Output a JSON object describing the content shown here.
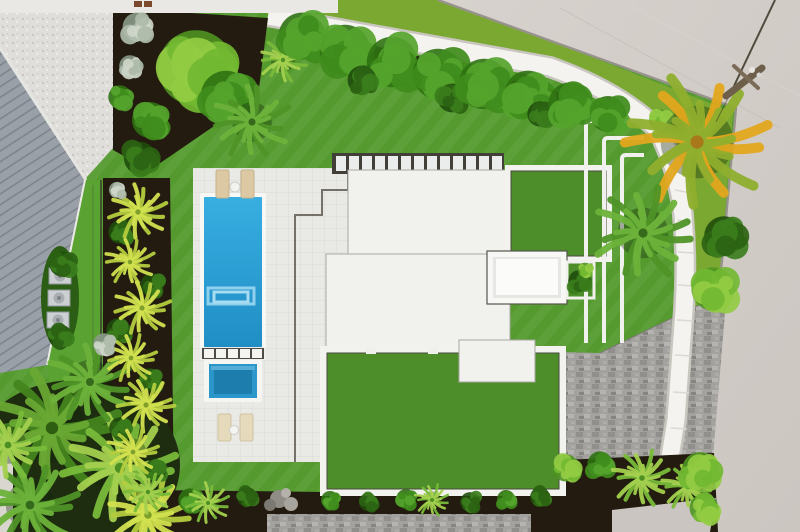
{
  "scene": {
    "description": "Aerial drone photograph of a modern flat-roof home with rectangular swimming pool, spa, white sun deck, artificial turf lawn and roof sections, curved white walkway, tropical landscaping and street at top right",
    "palette": {
      "lawn": "#549a2e",
      "verge": "#7aa831",
      "road": "#d1ccc7",
      "roadEdge": "#97938c",
      "walk": "#f4f3ef",
      "walkShadow": "#c9c5bf",
      "mulch": "#241b10",
      "metal": "#99a0a8",
      "roof": "#f1f1ee",
      "turf": "#4d8e2a",
      "deck": "#e9e9e5",
      "pool": "#2ba6da",
      "poolDeep": "#1f8ec4",
      "spa": "#2b96ca",
      "spaDeep": "#1d7eae",
      "pavers": "#a4a29e",
      "neighborPav": "#e0deda",
      "sidewalk": "#e9e8e4",
      "fence": "#39362e",
      "lounger": "#dcc9a4"
    },
    "house": {
      "paver_row": {
        "x": 336,
        "y": 156,
        "w": 10,
        "h": 15,
        "step": 13,
        "count": 13
      }
    },
    "pool": {
      "divider_squares": {
        "x": 204,
        "y": 349,
        "w": 10,
        "h": 9,
        "step": 12,
        "count": 5
      }
    },
    "vegetation": [
      {
        "type": "palm",
        "kind": "mixG",
        "x": 52,
        "y": 428,
        "r": 62
      },
      {
        "type": "palm",
        "kind": "bright",
        "x": 120,
        "y": 468,
        "r": 52
      },
      {
        "type": "palm",
        "kind": "green",
        "x": 30,
        "y": 505,
        "r": 44
      },
      {
        "type": "palm",
        "kind": "yellow",
        "x": 148,
        "y": 515,
        "r": 38
      },
      {
        "type": "palm",
        "kind": "green",
        "x": 90,
        "y": 382,
        "r": 40
      },
      {
        "type": "palm",
        "kind": "bright",
        "x": 8,
        "y": 445,
        "r": 34
      },
      {
        "type": "bush",
        "kind": "bushDark",
        "x": 120,
        "y": 232,
        "r": 13
      },
      {
        "type": "bush",
        "kind": "bushDark",
        "x": 152,
        "y": 285,
        "r": 13
      },
      {
        "type": "bush",
        "kind": "bushDark",
        "x": 118,
        "y": 330,
        "r": 13
      },
      {
        "type": "bush",
        "kind": "bushDark",
        "x": 150,
        "y": 380,
        "r": 13
      },
      {
        "type": "bush",
        "kind": "bushDark",
        "x": 120,
        "y": 428,
        "r": 12
      },
      {
        "type": "bush",
        "kind": "bushDark",
        "x": 155,
        "y": 470,
        "r": 12
      },
      {
        "type": "palm",
        "kind": "yellow",
        "x": 138,
        "y": 212,
        "r": 27
      },
      {
        "type": "palm",
        "kind": "yellow",
        "x": 130,
        "y": 262,
        "r": 23
      },
      {
        "type": "palm",
        "kind": "yellow",
        "x": 142,
        "y": 308,
        "r": 26
      },
      {
        "type": "palm",
        "kind": "yellow",
        "x": 131,
        "y": 358,
        "r": 24
      },
      {
        "type": "palm",
        "kind": "yellow",
        "x": 146,
        "y": 405,
        "r": 26
      },
      {
        "type": "palm",
        "kind": "yellow",
        "x": 133,
        "y": 452,
        "r": 24
      },
      {
        "type": "palm",
        "kind": "bright",
        "x": 148,
        "y": 492,
        "r": 22
      },
      {
        "type": "bush",
        "kind": "silver",
        "x": 137,
        "y": 27,
        "r": 16
      },
      {
        "type": "bush",
        "kind": "silver",
        "x": 130,
        "y": 66,
        "r": 12
      },
      {
        "type": "bush",
        "kind": "silver",
        "x": 104,
        "y": 344,
        "r": 12
      },
      {
        "type": "bush",
        "kind": "silver",
        "x": 117,
        "y": 190,
        "r": 9
      },
      {
        "type": "bush",
        "kind": "bush",
        "x": 150,
        "y": 120,
        "r": 20
      },
      {
        "type": "bush",
        "kind": "bushDark",
        "x": 140,
        "y": 158,
        "r": 18
      },
      {
        "type": "bush",
        "kind": "bush",
        "x": 120,
        "y": 97,
        "r": 13
      },
      {
        "type": "bush",
        "kind": "bushBright",
        "x": 196,
        "y": 68,
        "r": 42
      },
      {
        "type": "bush",
        "kind": "bush",
        "x": 226,
        "y": 96,
        "r": 28
      },
      {
        "type": "palm",
        "kind": "green",
        "x": 252,
        "y": 122,
        "r": 36
      },
      {
        "type": "palm",
        "kind": "bright",
        "x": 283,
        "y": 60,
        "r": 22
      },
      {
        "type": "bush",
        "kind": "bush",
        "x": 302,
        "y": 36,
        "r": 26
      },
      {
        "type": "bush",
        "kind": "bush",
        "x": 345,
        "y": 50,
        "r": 28
      },
      {
        "type": "bush",
        "kind": "bush",
        "x": 392,
        "y": 62,
        "r": 28
      },
      {
        "type": "bush",
        "kind": "bushDark",
        "x": 362,
        "y": 80,
        "r": 16
      },
      {
        "type": "bush",
        "kind": "bush",
        "x": 438,
        "y": 74,
        "r": 28
      },
      {
        "type": "bush",
        "kind": "bushDark",
        "x": 452,
        "y": 98,
        "r": 16
      },
      {
        "type": "bush",
        "kind": "bush",
        "x": 484,
        "y": 84,
        "r": 28
      },
      {
        "type": "bush",
        "kind": "bush",
        "x": 528,
        "y": 94,
        "r": 26
      },
      {
        "type": "bush",
        "kind": "bushDark",
        "x": 540,
        "y": 114,
        "r": 14
      },
      {
        "type": "bush",
        "kind": "bush",
        "x": 570,
        "y": 104,
        "r": 24
      },
      {
        "type": "bush",
        "kind": "bush",
        "x": 608,
        "y": 114,
        "r": 20
      },
      {
        "type": "bush",
        "kind": "bushBright",
        "x": 660,
        "y": 120,
        "r": 12
      },
      {
        "type": "bush",
        "kind": "bushDark",
        "x": 62,
        "y": 264,
        "r": 14
      },
      {
        "type": "bush",
        "kind": "bushDark",
        "x": 60,
        "y": 336,
        "r": 13
      },
      {
        "type": "palm",
        "kind": "golden",
        "x": 697,
        "y": 142,
        "r": 66
      },
      {
        "type": "palm",
        "kind": "green",
        "x": 643,
        "y": 233,
        "r": 46
      },
      {
        "type": "bush",
        "kind": "bushDark",
        "x": 724,
        "y": 236,
        "r": 22
      },
      {
        "type": "bush",
        "kind": "bushBright",
        "x": 713,
        "y": 289,
        "r": 24
      },
      {
        "type": "bush",
        "kind": "bushDark",
        "x": 579,
        "y": 281,
        "r": 12
      },
      {
        "type": "bush",
        "kind": "bushBright",
        "x": 585,
        "y": 270,
        "r": 8
      },
      {
        "type": "bush",
        "kind": "bush",
        "x": 190,
        "y": 500,
        "r": 13
      },
      {
        "type": "bush",
        "kind": "bushDark",
        "x": 247,
        "y": 497,
        "r": 11
      },
      {
        "type": "bush",
        "kind": "bush",
        "x": 330,
        "y": 500,
        "r": 10
      },
      {
        "type": "bush",
        "kind": "bushDark",
        "x": 368,
        "y": 502,
        "r": 10
      },
      {
        "type": "bush",
        "kind": "bush",
        "x": 406,
        "y": 499,
        "r": 11
      },
      {
        "type": "bush",
        "kind": "bushDark",
        "x": 470,
        "y": 502,
        "r": 11
      },
      {
        "type": "bush",
        "kind": "bush",
        "x": 506,
        "y": 499,
        "r": 10
      },
      {
        "type": "bush",
        "kind": "bushDark",
        "x": 540,
        "y": 497,
        "r": 11
      },
      {
        "type": "bush",
        "kind": "bushBright",
        "x": 566,
        "y": 468,
        "r": 15
      },
      {
        "type": "bush",
        "kind": "bush",
        "x": 600,
        "y": 464,
        "r": 14
      },
      {
        "type": "palm",
        "kind": "bright",
        "x": 208,
        "y": 503,
        "r": 20
      },
      {
        "type": "palm",
        "kind": "bright",
        "x": 432,
        "y": 500,
        "r": 16
      },
      {
        "type": "palm",
        "kind": "bright",
        "x": 642,
        "y": 478,
        "r": 28
      },
      {
        "type": "palm",
        "kind": "bright",
        "x": 688,
        "y": 487,
        "r": 24
      },
      {
        "type": "bush",
        "kind": "bushBright",
        "x": 700,
        "y": 470,
        "r": 20
      },
      {
        "type": "bush",
        "kind": "bushBright",
        "x": 704,
        "y": 508,
        "r": 16
      }
    ]
  }
}
